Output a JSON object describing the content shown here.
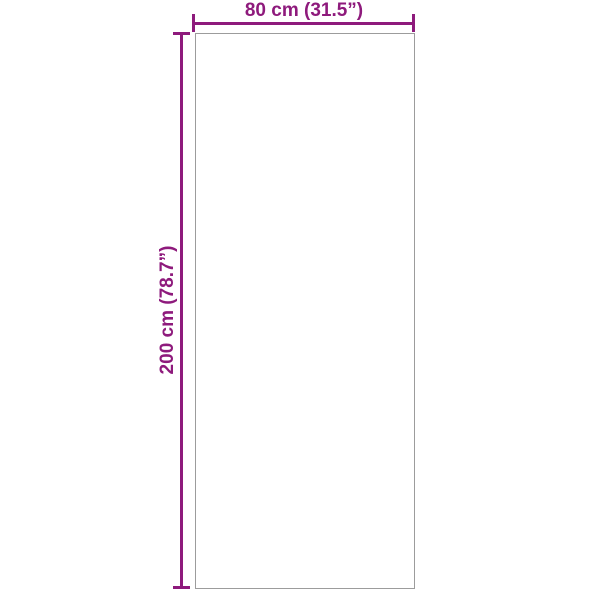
{
  "diagram": {
    "type": "product-dimensions",
    "shape": "rectangle",
    "width_label": "80 cm (31.5”)",
    "height_label": "200 cm (78.7”)",
    "width_cm": 80,
    "width_inches": 31.5,
    "height_cm": 200,
    "height_inches": 78.7,
    "accent_color": "#8E1A7C",
    "outline_color": "#9C9C9C",
    "background_color": "#FFFFFF"
  }
}
